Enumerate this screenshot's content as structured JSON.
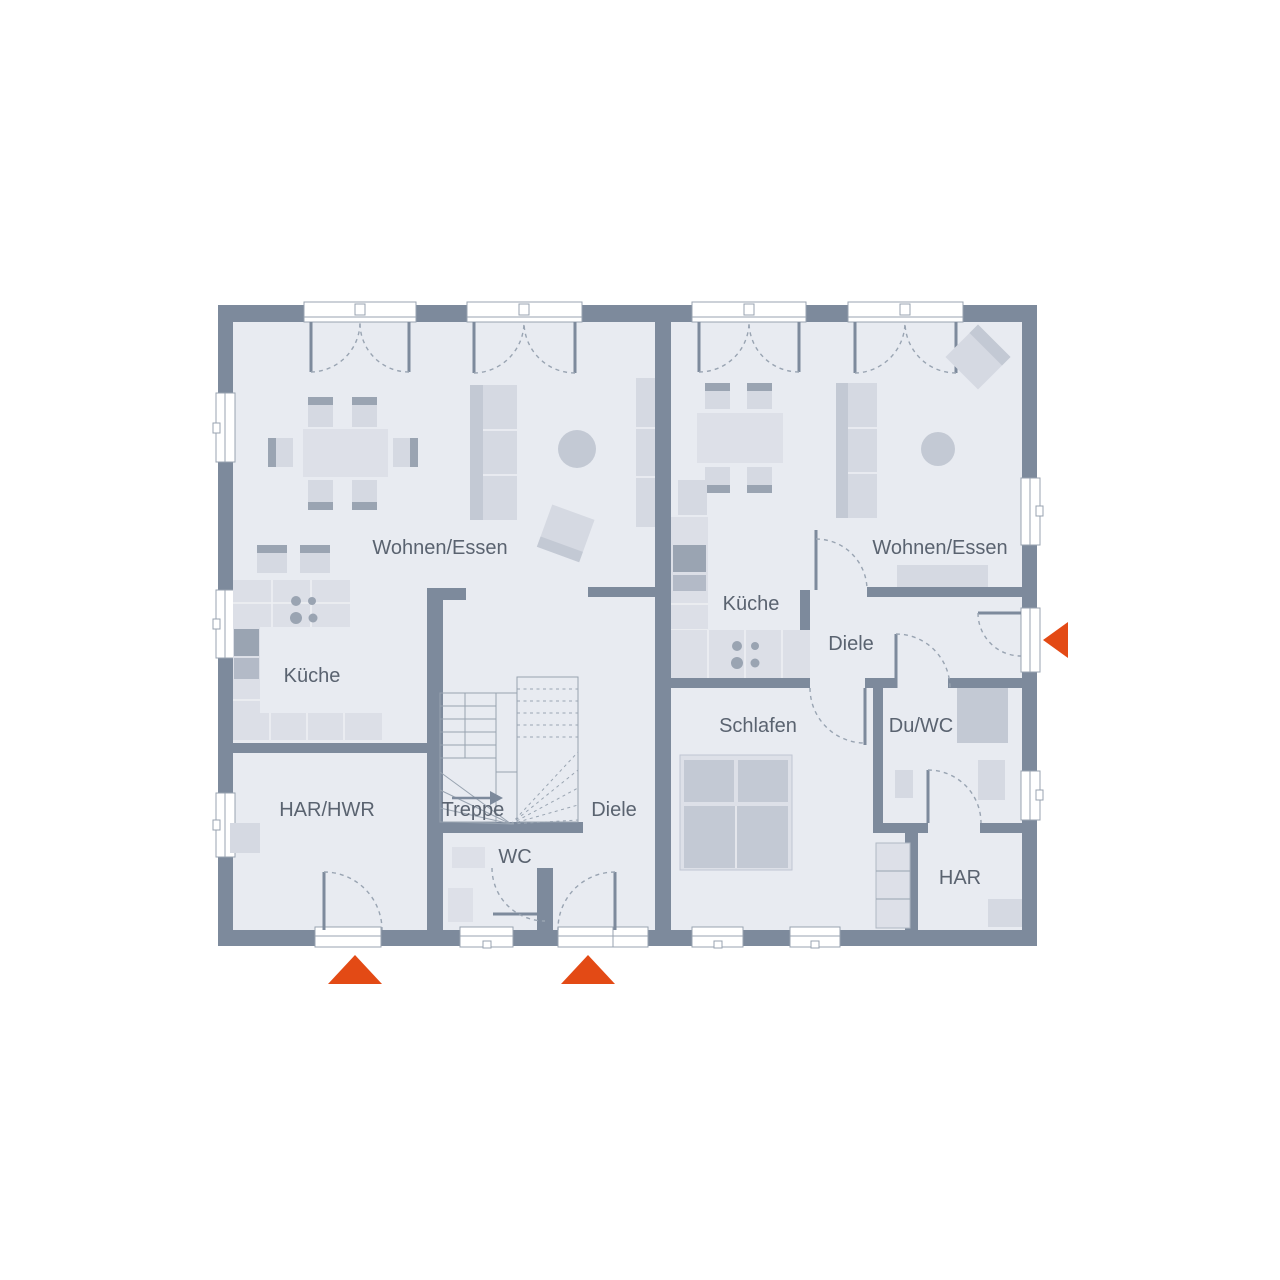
{
  "plan": {
    "type": "duplex-ground-floor-plan",
    "colors": {
      "wall": "#7d8a9c",
      "floor": "#e8ebf1",
      "furniture_light": "#d5d9e2",
      "furniture_medium": "#c3c9d4",
      "furniture_dark": "#9aa4b2",
      "entrance_arrow": "#e34a15",
      "label_text": "#5a6370"
    },
    "units": {
      "left": {
        "rooms": [
          {
            "id": "wohnen-essen",
            "label": "Wohnen/Essen"
          },
          {
            "id": "kueche",
            "label": "Küche"
          },
          {
            "id": "har-hwr",
            "label": "HAR/HWR"
          },
          {
            "id": "treppe",
            "label": "Treppe"
          },
          {
            "id": "diele",
            "label": "Diele"
          },
          {
            "id": "wc",
            "label": "WC"
          }
        ]
      },
      "right": {
        "rooms": [
          {
            "id": "wohnen-essen",
            "label": "Wohnen/Essen"
          },
          {
            "id": "kueche",
            "label": "Küche"
          },
          {
            "id": "diele",
            "label": "Diele"
          },
          {
            "id": "schlafen",
            "label": "Schlafen"
          },
          {
            "id": "du-wc",
            "label": "Du/WC"
          },
          {
            "id": "har",
            "label": "HAR"
          }
        ]
      }
    },
    "markers": {
      "entrances": [
        {
          "id": "entrance-left-har",
          "direction": "up"
        },
        {
          "id": "entrance-left-main",
          "direction": "up"
        },
        {
          "id": "entrance-right-main",
          "direction": "left"
        }
      ]
    }
  }
}
